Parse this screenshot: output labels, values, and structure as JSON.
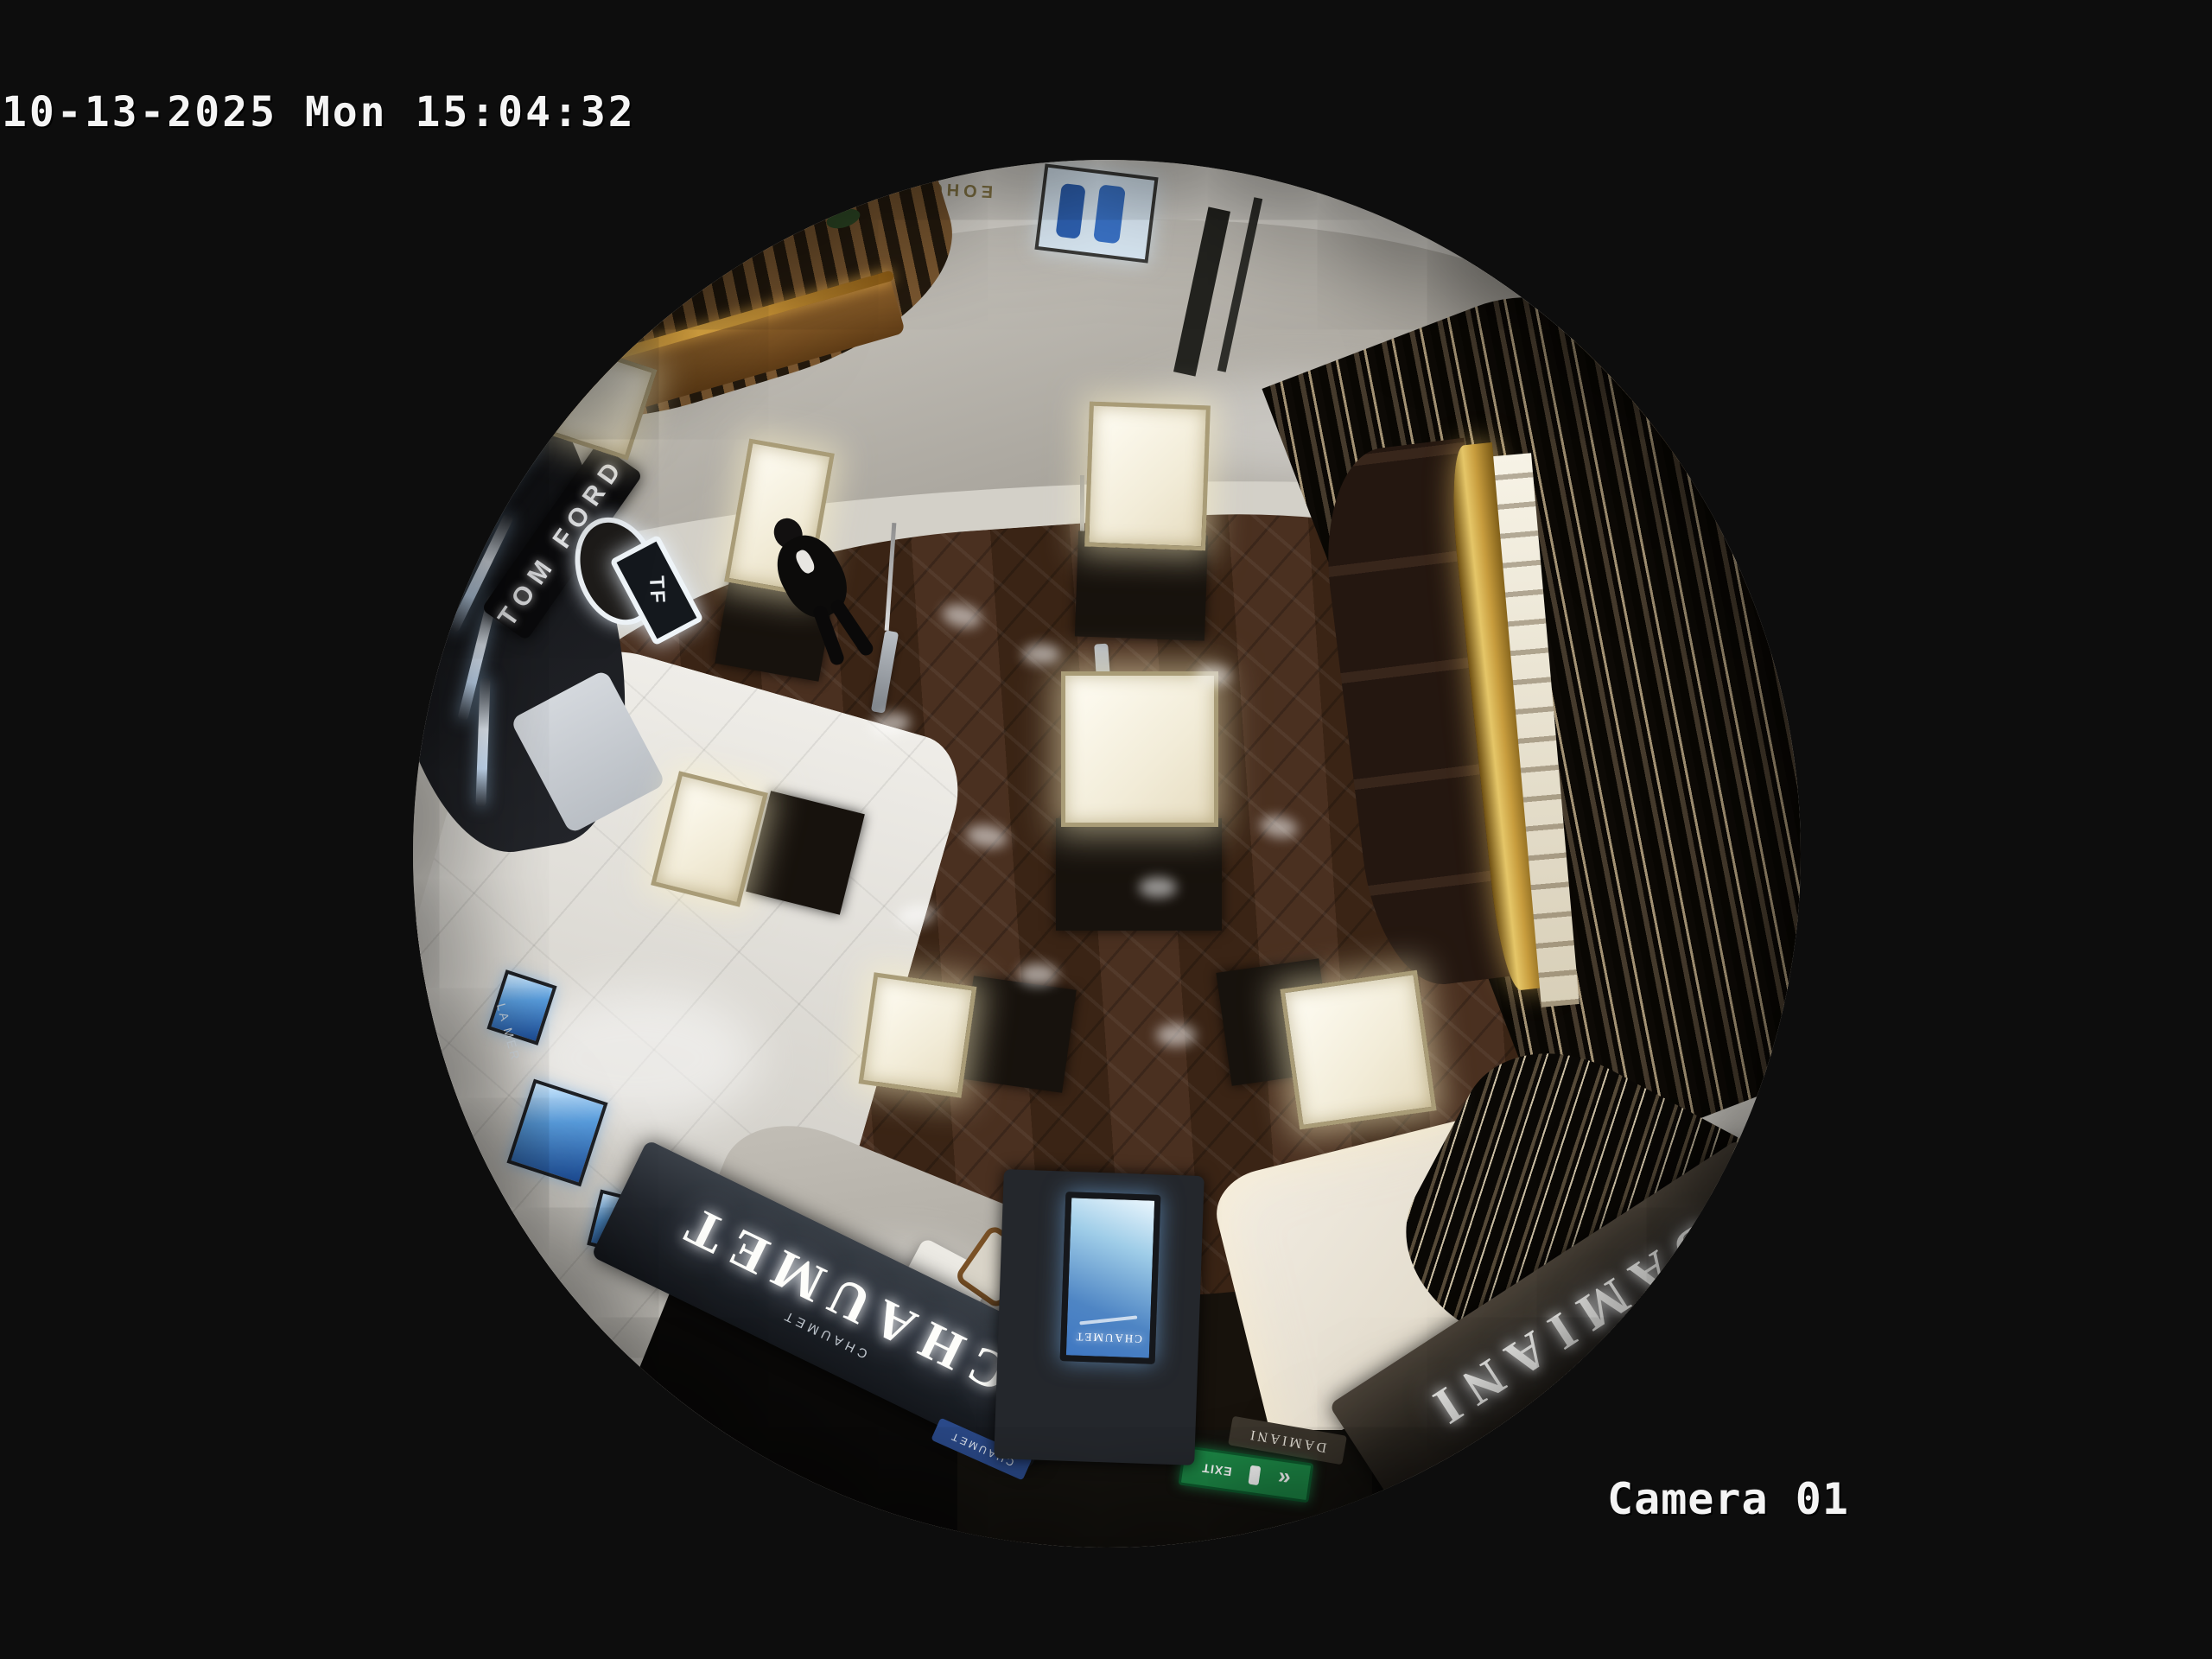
{
  "overlay": {
    "timestamp": "10-13-2025 Mon 15:04:32",
    "camera_label": "Camera 01"
  },
  "scene": {
    "signs": {
      "chaumet_main": "CHAUMET",
      "chaumet_sub": "CHAUMET",
      "chaumet_plaque": "CHAUMET",
      "kiosk_brand": "CHAUMET",
      "damiani_main": "DAMIANI",
      "damiani_small": "DAMIANI",
      "tom_ford": "TOM FORD",
      "tf_logo": "TF",
      "la_mer": "LA MER",
      "exit": "EXIT",
      "mirrored_wall_text": "EOHCX"
    },
    "colors": {
      "background": "#0d0d0d",
      "overlay_text": "#f4f4f4",
      "ring": "#d6d3cc",
      "marble": "#b7b3ab",
      "wood": "#40291b",
      "tile": "#dddbd5",
      "chaumet_band": "#23272e",
      "damiani_band": "#2e2922",
      "slat": "#1a1209",
      "gold": "#c89d3e",
      "exit_green": "#1d8a47",
      "screen_blue": "#3f77c2"
    }
  }
}
